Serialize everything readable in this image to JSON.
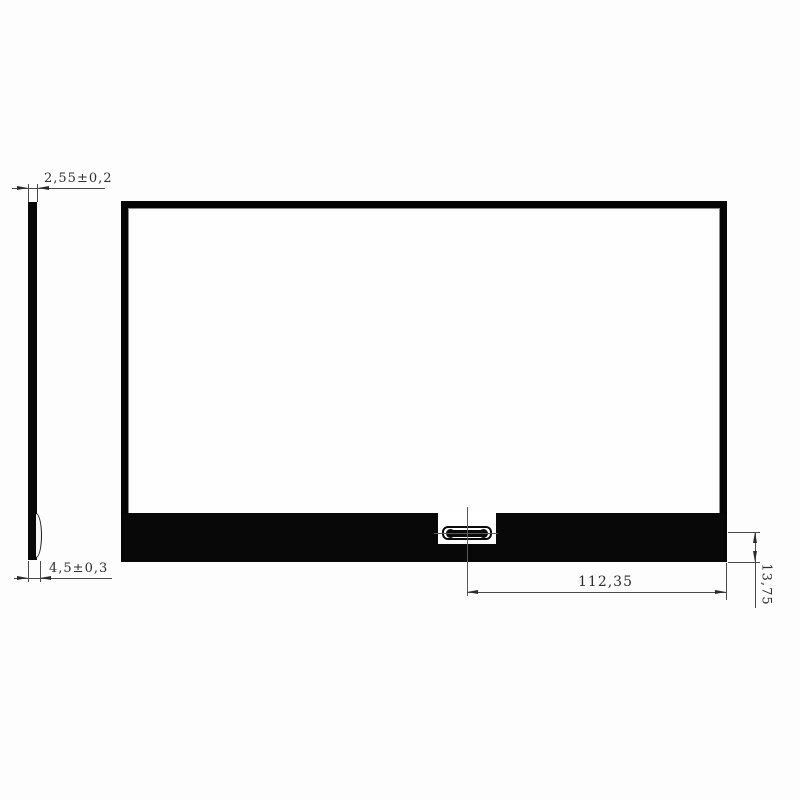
{
  "drawing": {
    "type": "mechanical-outline-drawing",
    "subject": "display-panel",
    "colors": {
      "ink": "#080808",
      "thin_line": "#4a4a4a",
      "text": "#2e2e2e",
      "background": "#fdfdfd"
    },
    "dims": {
      "panel_thickness": "2,55±0,2",
      "total_thickness": "4,5±0,3",
      "connector_center_to_right_edge": "112,35",
      "connector_center_to_bottom_edge": "13,75"
    },
    "views": {
      "side_view": "panel edge profile with connector bump",
      "front_view": "panel rear outline with bottom board strip and centered FPC connector"
    }
  }
}
